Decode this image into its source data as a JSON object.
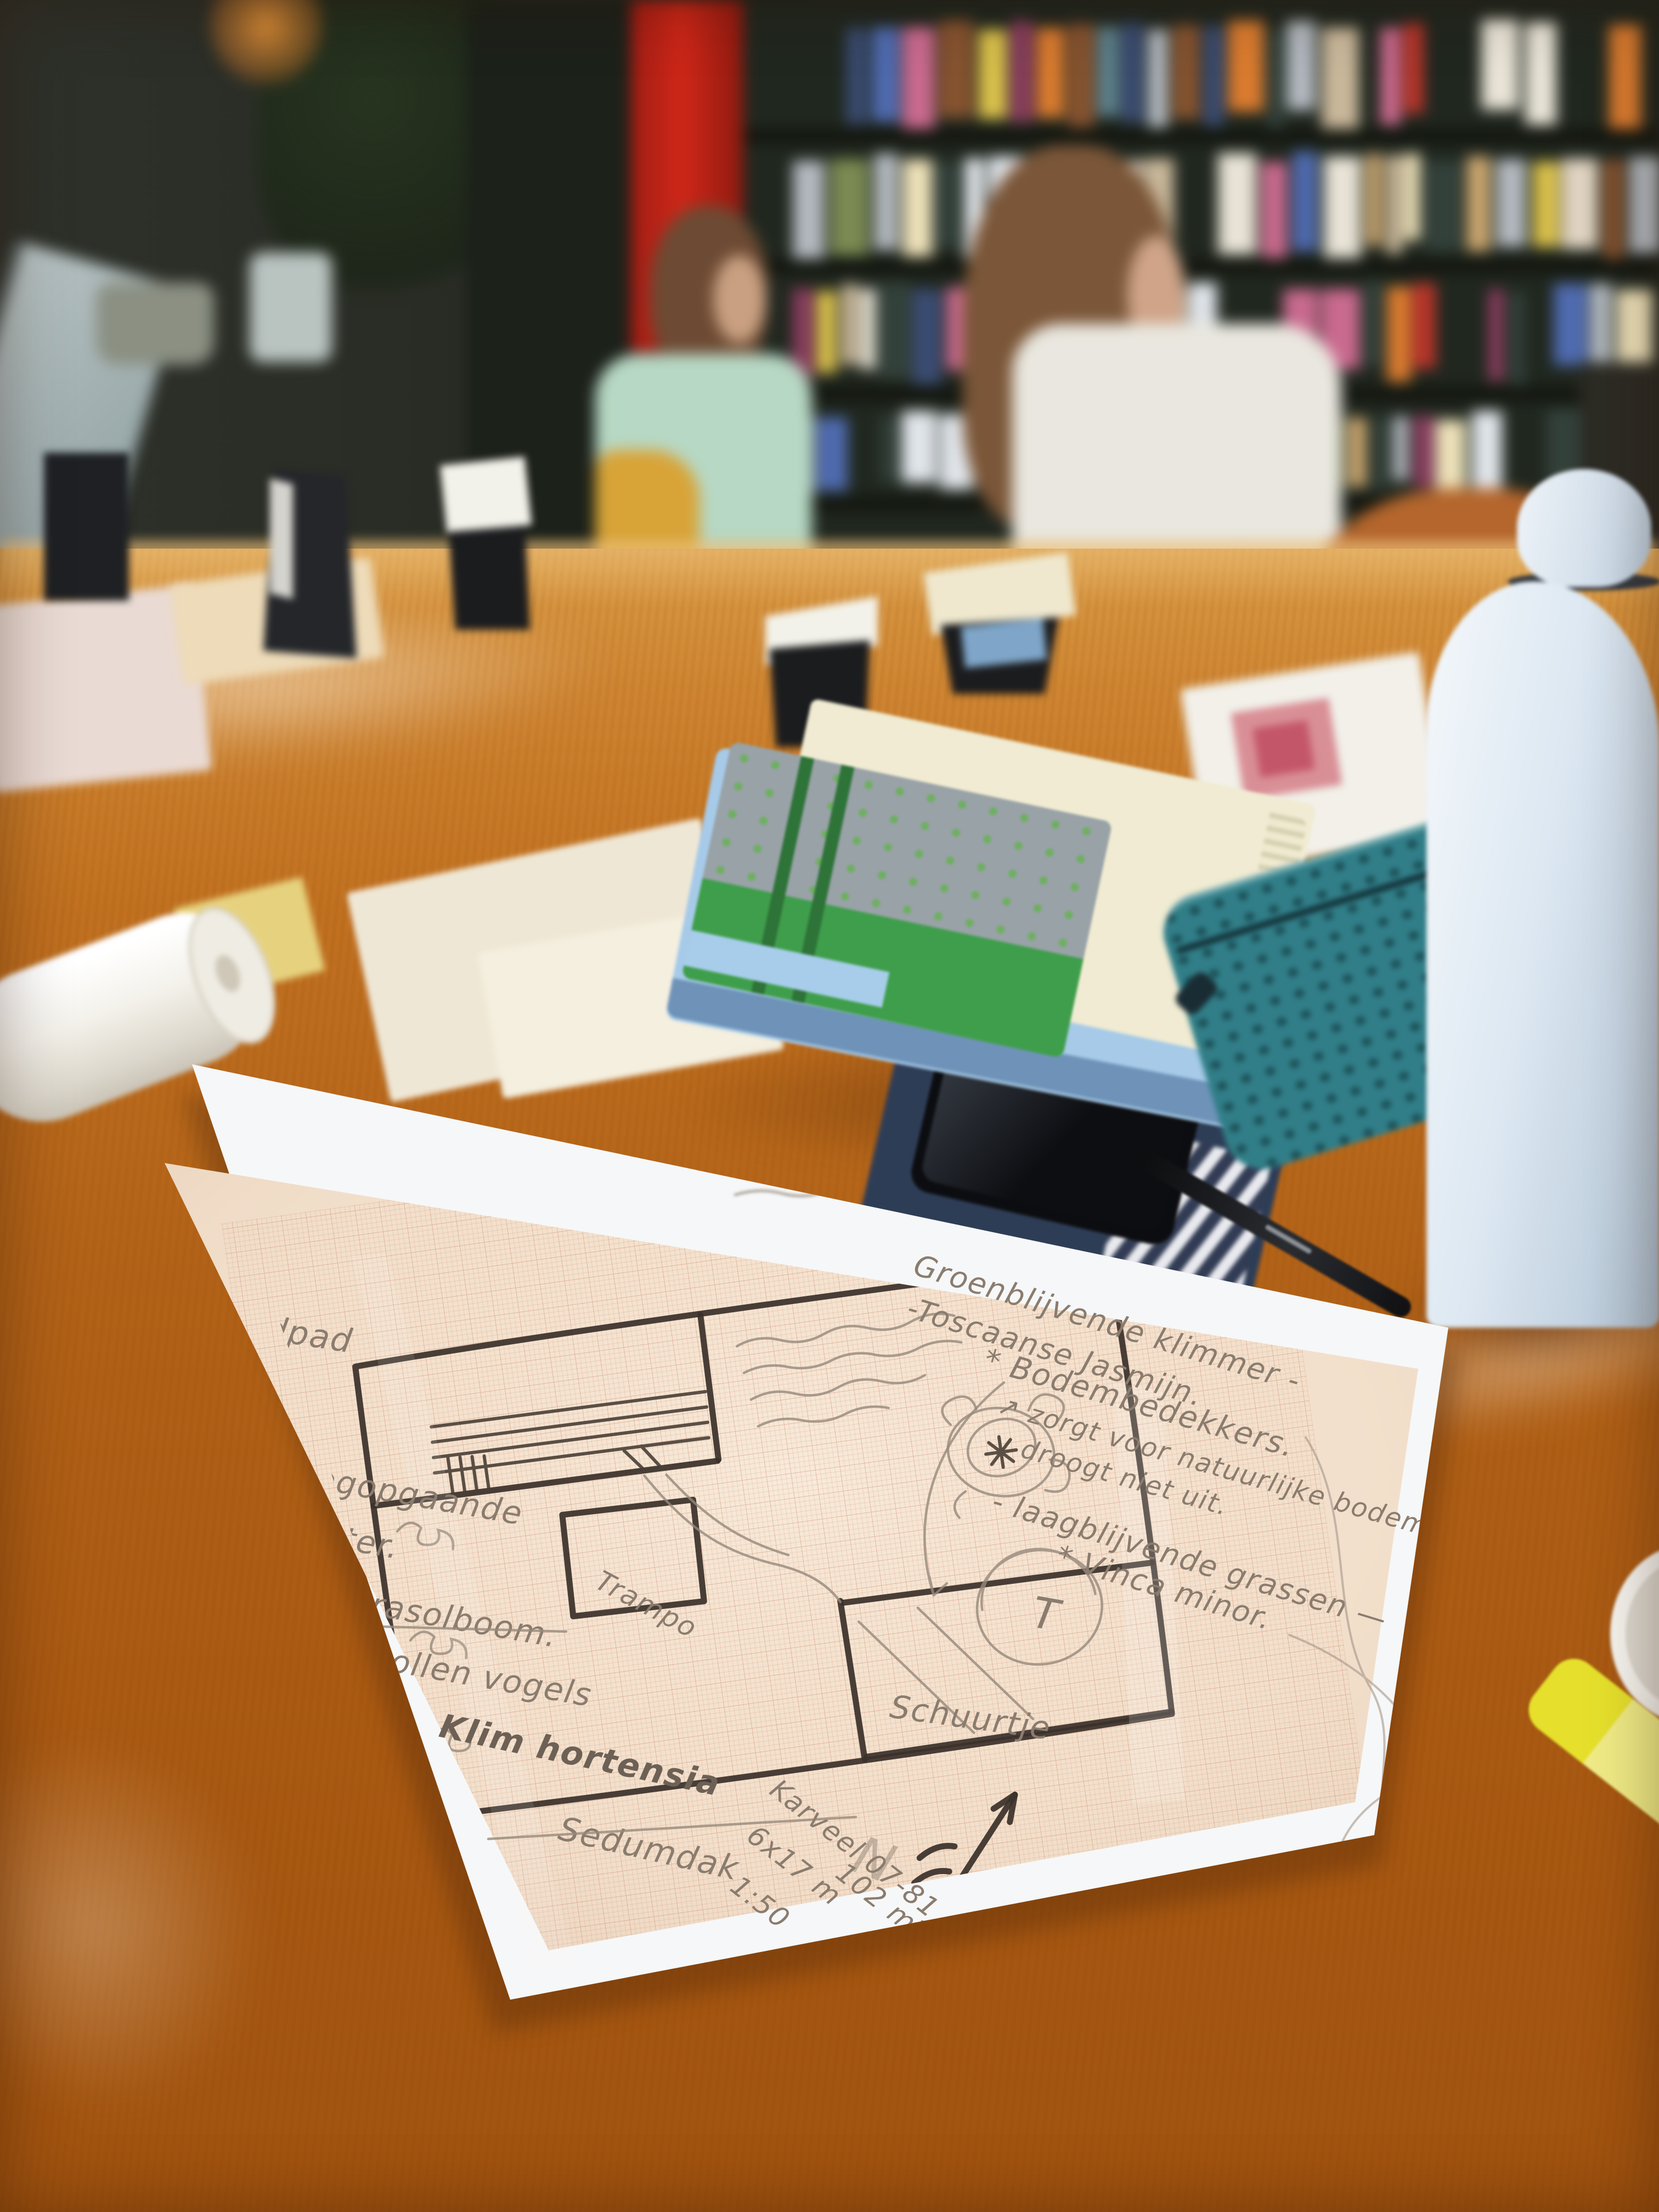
{
  "sketch": {
    "labels": {
      "grindpad": "Grindpad",
      "shrub1": "hoogopgaande",
      "shrub2": "heester.",
      "parasol": "Parasolboom.",
      "vetbollen": "Vetbollen vogels",
      "klim": "Klim hortensia",
      "sedum": "Sedumdak",
      "trampoline": "Trampo",
      "tree": "T",
      "shed": "Schuurtje",
      "north": "N"
    },
    "notes": {
      "climber1": "Groenblijvende klimmer -",
      "climber2": "-Toscaanse Jasmijn.",
      "ground1": "* Bodembedekkers.",
      "ground2": "↗ zorgt voor natuurlijke bodem",
      "ground3": "droogt niet uit.",
      "ground4": "- laagblijvende grassen —",
      "ground5": "* Vinca minor."
    },
    "plot": {
      "code": "Karveel 07-81",
      "size": "6x17 m",
      "scale": "1:50",
      "area": "102 m²"
    }
  },
  "background": {
    "book_palette": [
      "#c9b79a",
      "#d97b2f",
      "#b8352a",
      "#e8e3d6",
      "#7a8a52",
      "#3a4c72",
      "#d9c04b",
      "#8a3d5e",
      "#e0e5ea",
      "#5c7f8a",
      "#caa66f",
      "#33413b",
      "#c96a8e",
      "#ece0b8",
      "#4f6bb0",
      "#b2b8be",
      "#86532f",
      "#dfd2c0"
    ]
  },
  "colors": {
    "wood": "#b36318",
    "pillar_red": "#cf2718",
    "tracing_paper": "#f2e0cc",
    "marker_ink": "#3b322b",
    "pencil": "#8a7c6e",
    "notebook_green": "#3f9e4b",
    "notebook_blue": "#a6cae8",
    "pencil_case_teal": "#317e88",
    "bottle": "#dde8f2",
    "highlighter": "#e6e02c"
  }
}
